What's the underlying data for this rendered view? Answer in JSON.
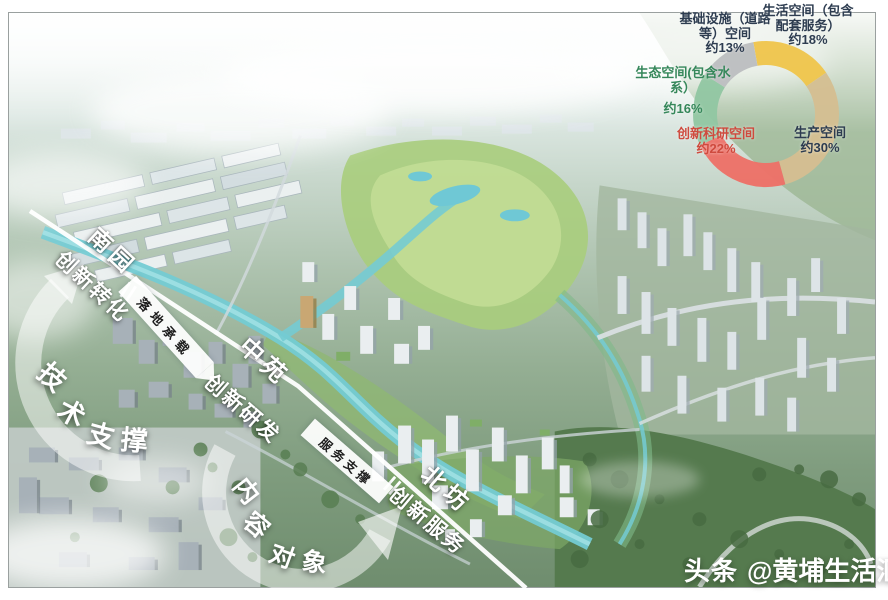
{
  "frame": {
    "watermark_prefix": "头条",
    "watermark_handle": "@黄埔生活汇"
  },
  "chart_data": {
    "type": "pie",
    "subtype": "donut",
    "title": "用地空间构成",
    "unit": "%",
    "start_angle_deg": -10,
    "center": [
      766,
      114
    ],
    "mid_radius": 61,
    "ring_width": 24,
    "slices": [
      {
        "name": "生活空间（包含配套服务）",
        "pct": 18,
        "color": "#f0c64d",
        "label_color": "#2d3c50",
        "label_lines": [
          "生活空间（包含",
          "配套服务）",
          "约18%"
        ]
      },
      {
        "name": "生产空间",
        "pct": 30,
        "color": "#d5bf92",
        "label_color": "#2d3c50",
        "label_lines": [
          "生产空间",
          "约30%"
        ]
      },
      {
        "name": "创新科研空间",
        "pct": 22,
        "color": "#ee7168",
        "label_color": "#cf4a3e",
        "label_lines": [
          "创新科研空间",
          "约22%"
        ]
      },
      {
        "name": "生态空间(包含水系）",
        "pct": 16,
        "color": "#92c7a3",
        "label_color": "#35875a",
        "label_lines": [
          "生态空间(包含水系）",
          "约16%"
        ]
      },
      {
        "name": "基础设施（道路等）空间",
        "pct": 13,
        "color": "#bdbfc1",
        "label_color": "#2d3c50",
        "label_lines": [
          "基础设施（道路",
          "等）空间",
          "约13%"
        ]
      }
    ]
  },
  "annotations": {
    "zones": [
      {
        "id": "nanyuan",
        "text": "南园"
      },
      {
        "id": "zhongyuan",
        "text": "中苑"
      },
      {
        "id": "beifang",
        "text": "北坊"
      }
    ],
    "flows": [
      {
        "id": "zhuanhua",
        "text": "创新转化"
      },
      {
        "id": "yanfa",
        "text": "创新研发"
      },
      {
        "id": "fuwu",
        "text": "创新服务"
      }
    ],
    "banners": [
      {
        "id": "luodi",
        "text": "落地承载"
      },
      {
        "id": "fuwuzhicheng",
        "text": "服务支撑"
      }
    ],
    "arcs": [
      {
        "id": "jishu",
        "text": "技术支撑"
      },
      {
        "id": "neirong",
        "text": "内容"
      },
      {
        "id": "duixiang",
        "text": "对象"
      }
    ]
  }
}
